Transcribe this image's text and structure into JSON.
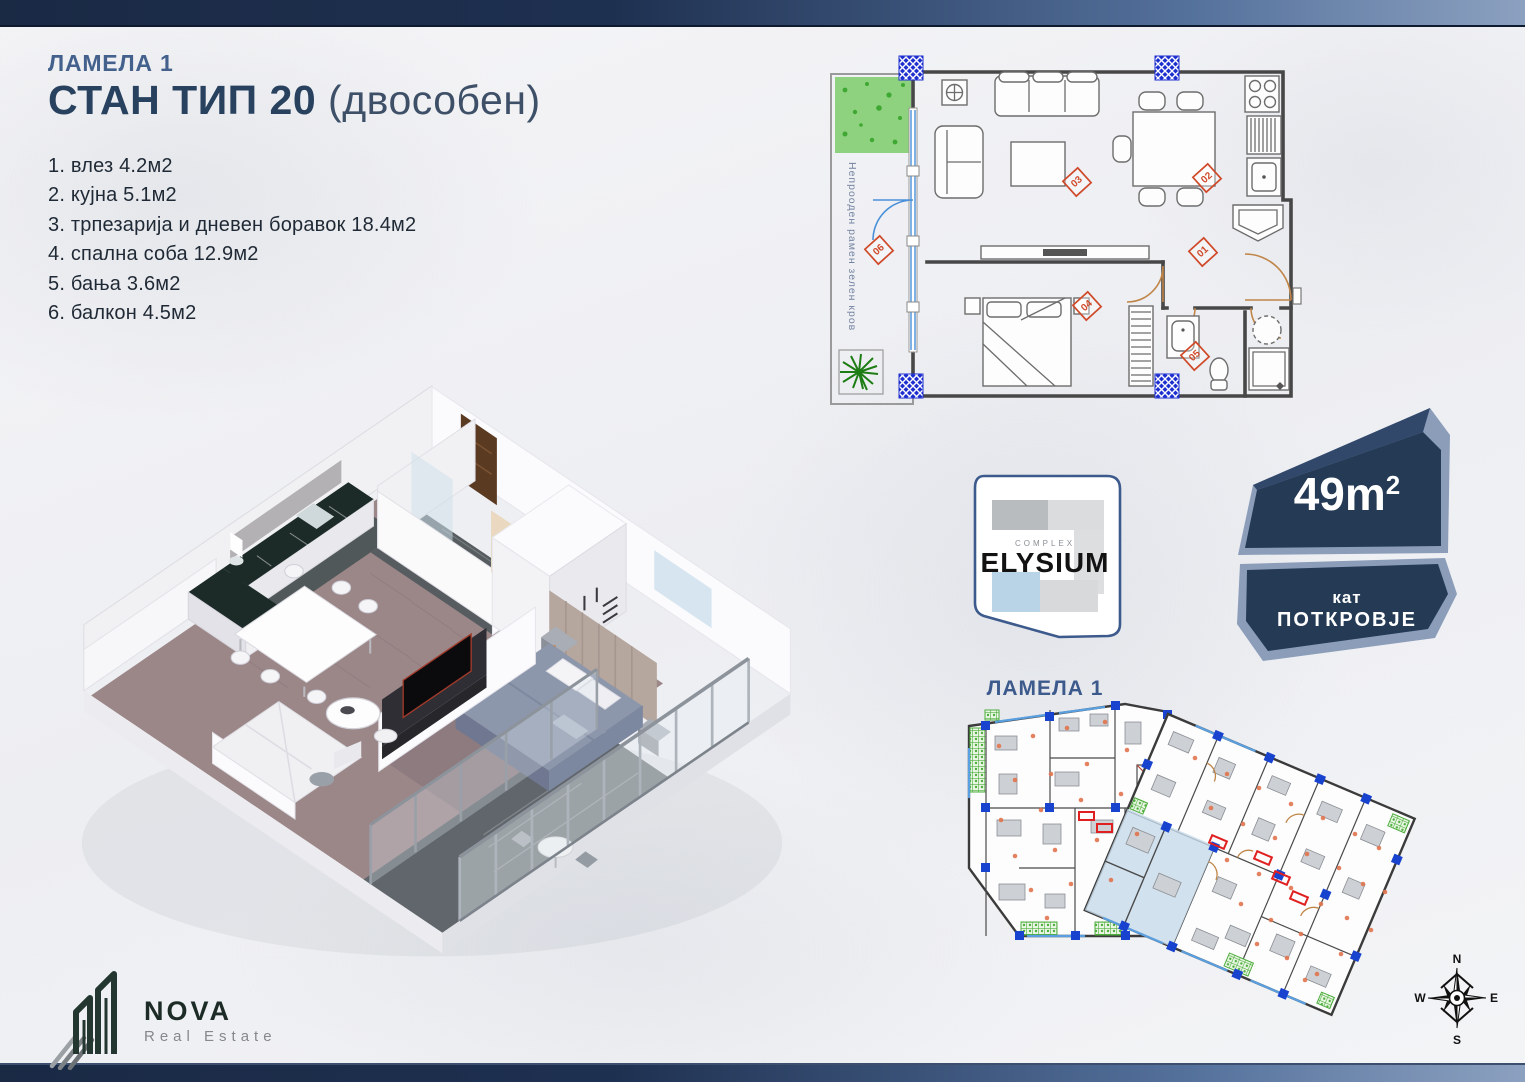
{
  "header": {
    "lamela": "ЛАМЕЛА 1",
    "title": "СТАН ТИП 20",
    "subtitle": "(двособен)"
  },
  "rooms": [
    "1. влез 4.2м2",
    "2. кујна 5.1м2",
    "3. трпезарија и дневен боравок 18.4м2",
    "4. спална соба 12.9м2",
    "5. бања 3.6м2",
    "6. балкон 4.5м2"
  ],
  "floorplan": {
    "green_roof_label": "Непрооден рамен зелен кров",
    "markers": [
      "01",
      "02",
      "03",
      "04",
      "05",
      "06"
    ]
  },
  "elysium": {
    "complex": "COMPLEX",
    "name": "ELYSIUM",
    "caption": "ЛАМЕЛА 1"
  },
  "badge": {
    "area": "49m",
    "area_sup": "2",
    "floor_small": "кат",
    "floor_big": "ПОТКРОВЈЕ"
  },
  "brand": {
    "name": "NOVA",
    "tagline": "Real Estate"
  },
  "compass": {
    "n": "N",
    "e": "E",
    "s": "S",
    "w": "W"
  },
  "colors": {
    "accent_navy": "#27415f",
    "label_blue": "#3d5a8c",
    "badge_dark": "#243a55",
    "badge_light": "#8b9db9",
    "marker_red": "#cf4a2a",
    "column_blue": "#1e2fd0",
    "terrace_green": "#8ed17e",
    "highlight_unit": "#c7d9ea"
  }
}
